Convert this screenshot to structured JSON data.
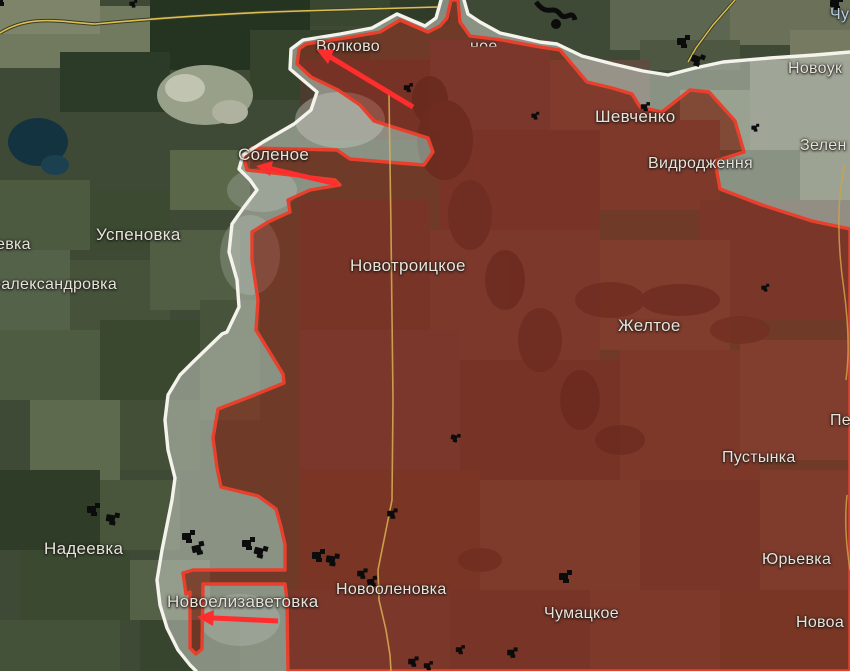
{
  "map": {
    "kind": "frontline-situation-map",
    "labels": {
      "volkovo": "Волково",
      "top_fragment": "ное",
      "shevchenko": "Шевченко",
      "vidrodzhennia": "Видродження",
      "novouk": "Новоук",
      "zelen": "Зелен",
      "chu": "Чу",
      "uspenovka": "Успеновка",
      "evka": "евка",
      "raleksandrovka": "ралександровка",
      "novotroitskoe": "Новотроицкое",
      "solenoe": "Соленое",
      "zheltoe": "Желтое",
      "pustynka": "Пустынка",
      "pe": "Пе",
      "nadeevka": "Надеевка",
      "novoelizavetovka": "Новоелизаветовка",
      "novoolenovka": "Новооленовка",
      "chumatskoe": "Чумацкое",
      "yurievka": "Юрьевка",
      "novoa": "Новоа"
    },
    "colors": {
      "occupied_fill": "#a2291c",
      "occupied_line": "#e8402c",
      "gray_zone_fill": "#c9cdc5",
      "frontline_white": "#f4f3ec",
      "arrow_red": "#ff2d2d",
      "road_yellow": "#d9b052",
      "admin_border_yellow": "#d9c14e",
      "label_text": "#e9e4d9"
    },
    "arrows": [
      {
        "name": "advance-arrow-volkovo",
        "from": [
          413,
          107
        ],
        "to": [
          316,
          49
        ]
      },
      {
        "name": "advance-arrow-solenoe",
        "from": [
          337,
          184
        ],
        "to": [
          256,
          166
        ]
      },
      {
        "name": "advance-arrow-novoelizavetovka",
        "from": [
          278,
          621
        ],
        "to": [
          197,
          617
        ]
      }
    ],
    "unit_markers": [
      {
        "x": 408,
        "y": 88
      },
      {
        "x": 683,
        "y": 42
      },
      {
        "x": 697,
        "y": 60
      },
      {
        "x": 836,
        "y": 4
      },
      {
        "x": 133,
        "y": 4
      },
      {
        "x": 645,
        "y": 107
      },
      {
        "x": 535,
        "y": 116
      },
      {
        "x": 755,
        "y": 128
      },
      {
        "x": 765,
        "y": 288
      },
      {
        "x": 455,
        "y": 438
      },
      {
        "x": 392,
        "y": 514
      },
      {
        "x": 93,
        "y": 510
      },
      {
        "x": 112,
        "y": 519
      },
      {
        "x": 188,
        "y": 537
      },
      {
        "x": 198,
        "y": 549
      },
      {
        "x": 248,
        "y": 544
      },
      {
        "x": 260,
        "y": 552
      },
      {
        "x": 318,
        "y": 556
      },
      {
        "x": 332,
        "y": 560
      },
      {
        "x": 362,
        "y": 574
      },
      {
        "x": 372,
        "y": 582
      },
      {
        "x": 565,
        "y": 577
      },
      {
        "x": 413,
        "y": 662
      },
      {
        "x": 428,
        "y": 666
      },
      {
        "x": 460,
        "y": 650
      },
      {
        "x": 512,
        "y": 653
      }
    ]
  }
}
